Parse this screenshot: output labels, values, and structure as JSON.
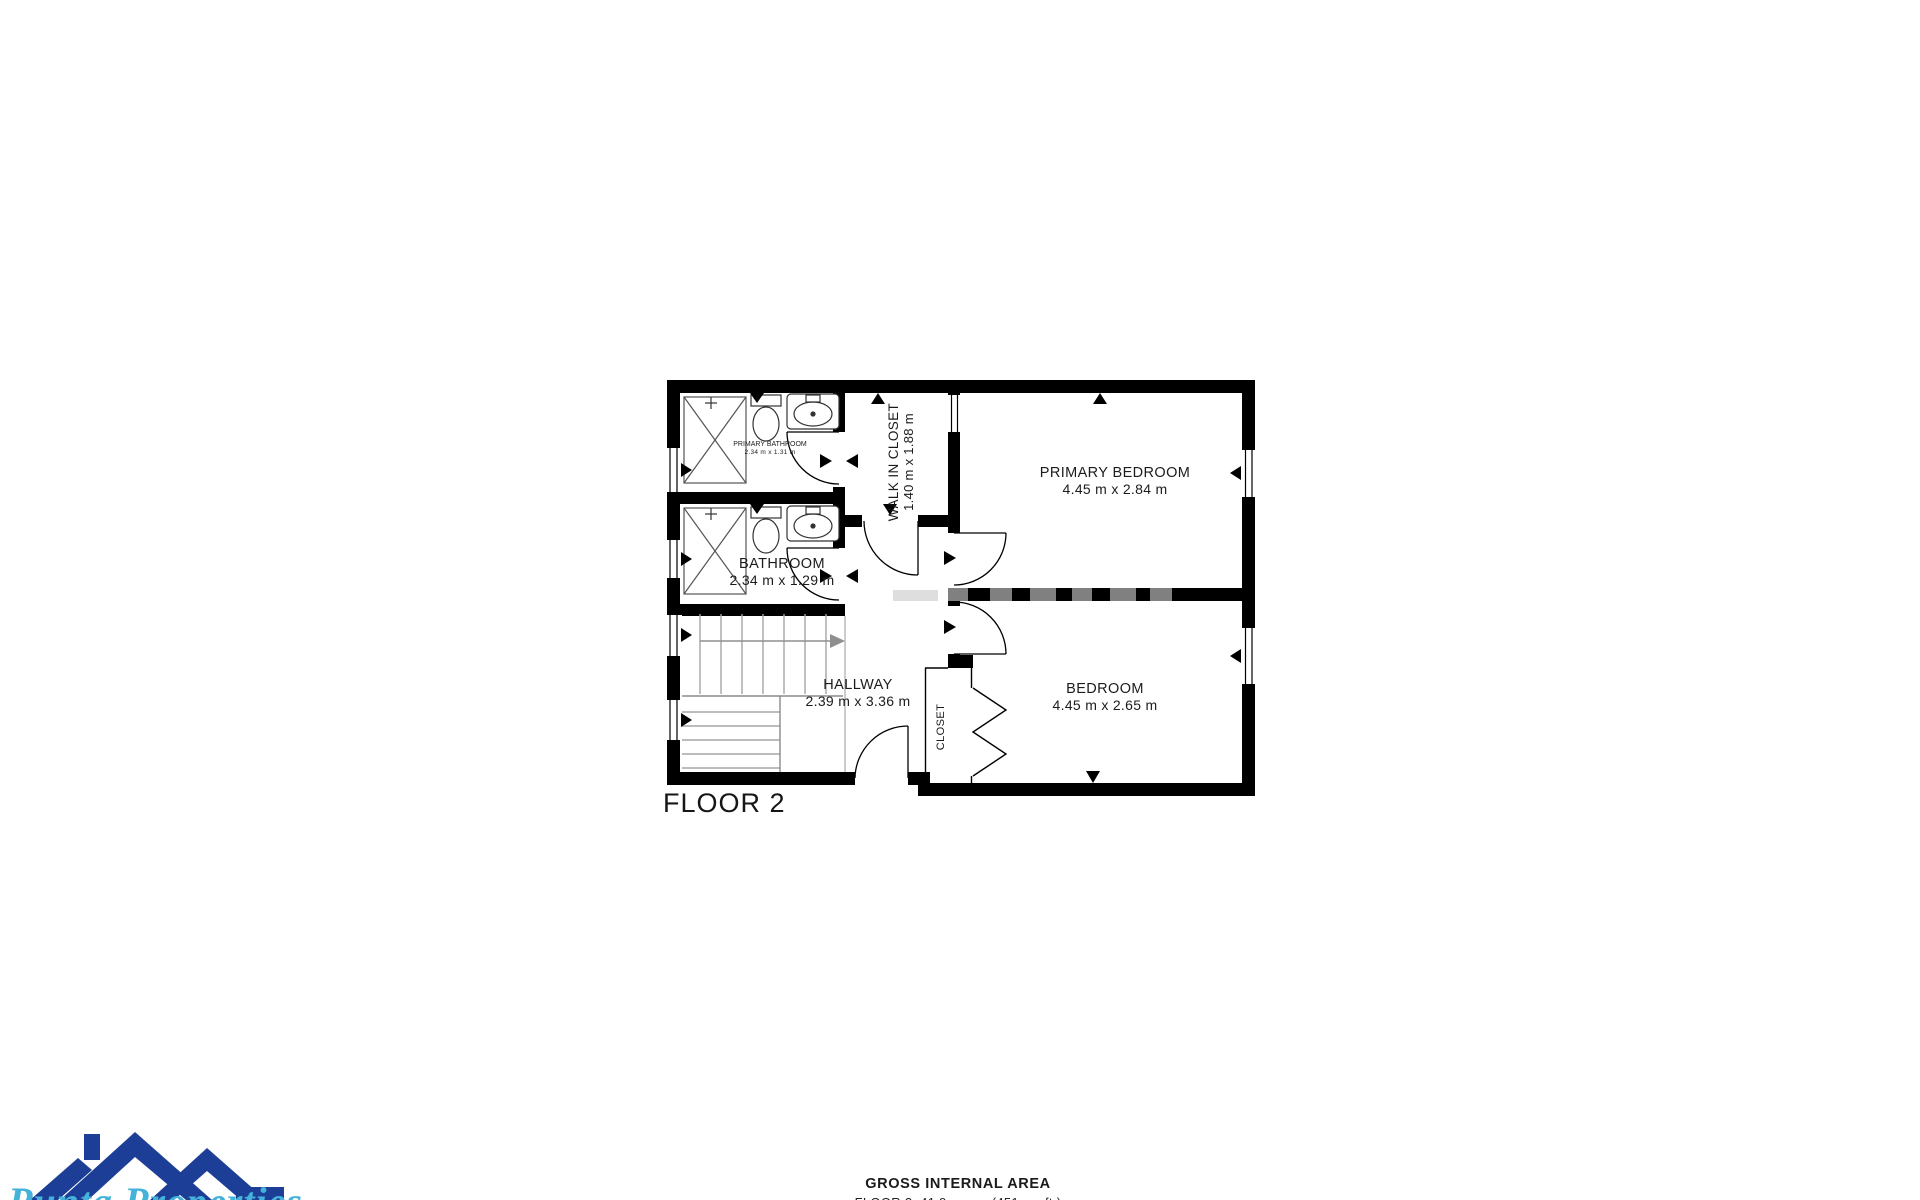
{
  "page": {
    "background": "#ffffff",
    "wall_color": "#000000"
  },
  "floorplan": {
    "floor_label": "FLOOR 2",
    "rooms": [
      {
        "name": "PRIMARY BATHROOM",
        "dims": "2.34 m x 1.31 m"
      },
      {
        "name": "BATHROOM",
        "dims": "2.34 m x 1.29 m"
      },
      {
        "name": "WALK IN CLOSET",
        "dims": "1.40 m x 1.88 m"
      },
      {
        "name": "PRIMARY BEDROOM",
        "dims": "4.45 m x 2.84 m"
      },
      {
        "name": "BEDROOM",
        "dims": "4.45 m x 2.65 m"
      },
      {
        "name": "HALLWAY",
        "dims": "2.39 m x 3.36 m"
      },
      {
        "name": "CLOSET",
        "dims": ""
      }
    ],
    "fixtures": [
      "shower",
      "toilet",
      "sink",
      "staircase",
      "bifold-closet-doors"
    ]
  },
  "footer": {
    "area_title": "GROSS INTERNAL AREA",
    "area_detail": "FLOOR 2: 41.9 sq. m. (451 sq. ft.)"
  },
  "branding": {
    "company": "Punta Properties",
    "logo_primary_color": "#1d3e96",
    "logo_script_color": "#45b2d9"
  }
}
